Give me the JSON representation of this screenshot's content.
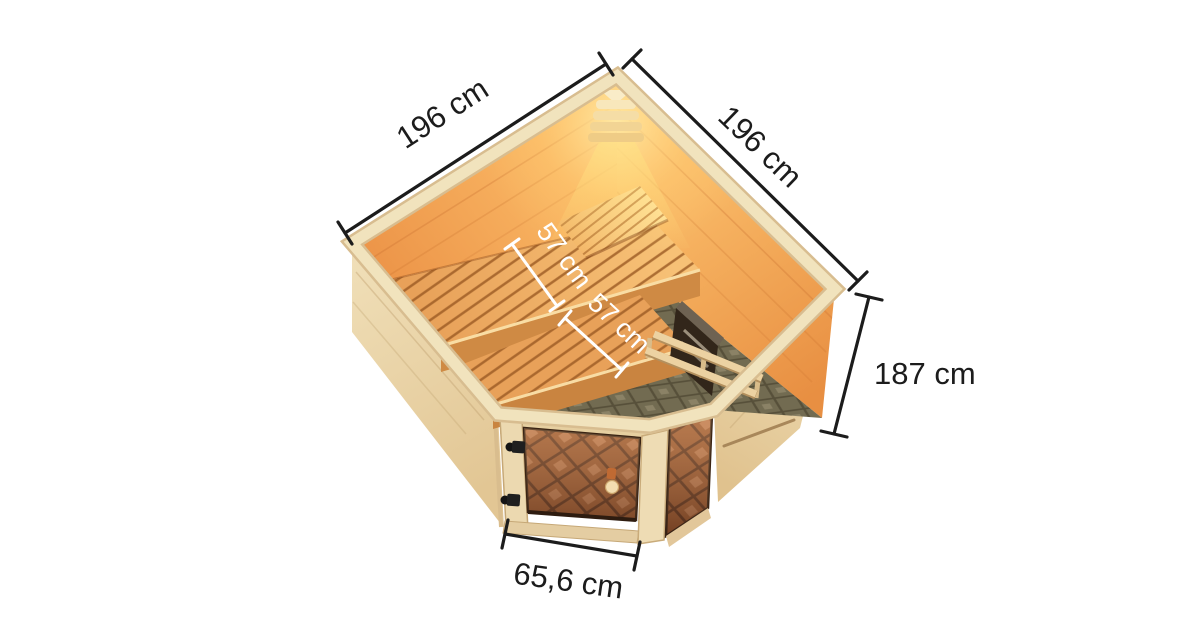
{
  "page": {
    "background": "#ffffff",
    "description": "Product dimension diagram: corner sauna seen from above"
  },
  "diagram": {
    "dimensions": {
      "outer_width_left": {
        "label": "196 cm"
      },
      "outer_width_right": {
        "label": "196 cm"
      },
      "outer_height": {
        "label": "187 cm"
      },
      "door_width": {
        "label": "65,6 cm"
      },
      "bench_depth_upper": {
        "label": "57 cm"
      },
      "bench_depth_lower": {
        "label": "57 cm"
      }
    },
    "parts": [
      "corner-lamp",
      "headrest",
      "upper-bench",
      "lower-bench",
      "sauna-heater",
      "heater-guard-rail",
      "glass-door",
      "corner-glass-panel",
      "tiled-floor",
      "interior-walls",
      "exterior-walls"
    ],
    "colors": {
      "dimension_line": "#1c1c1c",
      "bench_dimension_line": "#ffffff",
      "exterior_wood": "#ead6ab",
      "rim_wood": "#f1e3bd",
      "interior_wall": "#f09f56",
      "glow": "#ffe18a",
      "bench_wood": "#eaa55e",
      "floor_tile": "#726b51",
      "door_glass": "#8f5134",
      "heater_body": "#32261a"
    }
  }
}
